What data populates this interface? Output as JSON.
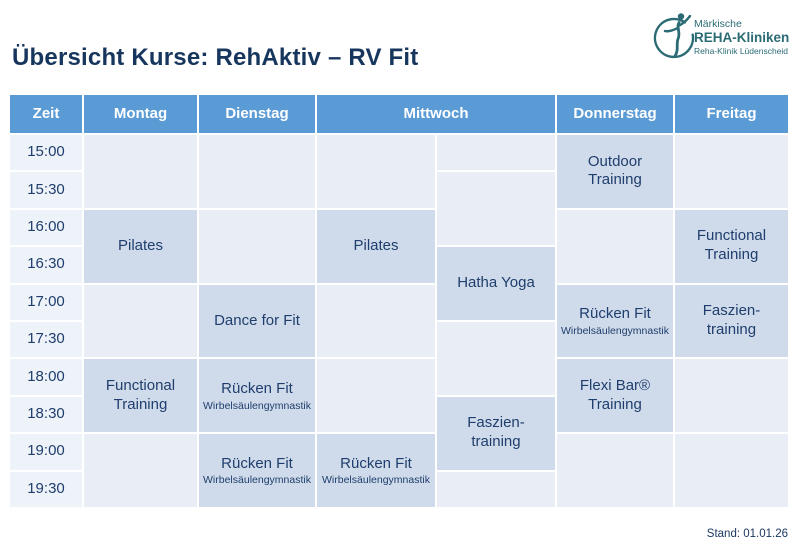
{
  "page": {
    "title": "Übersicht Kurse: RehAktiv – RV Fit",
    "stand": "Stand: 01.01.26"
  },
  "logo": {
    "icon": "person-in-circle-icon",
    "line1": "Märkische",
    "line2": "REHA-Kliniken",
    "line3": "Reha-Klinik Lüdenscheid"
  },
  "colors": {
    "header_bg": "#5b9bd5",
    "header_text": "#ffffff",
    "time_cell_bg": "#eef2f9",
    "empty_cell_bg": "#e9eef6",
    "course_cell_bg": "#cfdbea",
    "text_dark": "#1f3e6d",
    "title_text": "#17365d",
    "logo_teal": "#2b6b74"
  },
  "schedule": {
    "header_cells": [
      {
        "id": "zeit",
        "label": "Zeit",
        "col": 1,
        "span": 1
      },
      {
        "id": "montag",
        "label": "Montag",
        "col": 2,
        "span": 1
      },
      {
        "id": "dienstag",
        "label": "Dienstag",
        "col": 3,
        "span": 1
      },
      {
        "id": "mittwoch",
        "label": "Mittwoch",
        "col": 4,
        "span": 2
      },
      {
        "id": "donnerstag",
        "label": "Donnerstag",
        "col": 6,
        "span": 1
      },
      {
        "id": "freitag",
        "label": "Freitag",
        "col": 7,
        "span": 1
      }
    ],
    "times": [
      "15:00",
      "15:30",
      "16:00",
      "16:30",
      "17:00",
      "17:30",
      "18:00",
      "18:30",
      "19:00",
      "19:30"
    ],
    "cells": [
      {
        "day": "montag",
        "col": 2,
        "start": "15:00",
        "slots": 2,
        "title": "",
        "subtitle": "",
        "filled": false
      },
      {
        "day": "montag",
        "col": 2,
        "start": "16:00",
        "slots": 2,
        "title": "Pilates",
        "subtitle": "",
        "filled": true
      },
      {
        "day": "montag",
        "col": 2,
        "start": "17:00",
        "slots": 2,
        "title": "",
        "subtitle": "",
        "filled": false
      },
      {
        "day": "montag",
        "col": 2,
        "start": "18:00",
        "slots": 2,
        "title": "Functional\nTraining",
        "subtitle": "",
        "filled": true
      },
      {
        "day": "montag",
        "col": 2,
        "start": "19:00",
        "slots": 2,
        "title": "",
        "subtitle": "",
        "filled": false
      },
      {
        "day": "dienstag",
        "col": 3,
        "start": "15:00",
        "slots": 2,
        "title": "",
        "subtitle": "",
        "filled": false
      },
      {
        "day": "dienstag",
        "col": 3,
        "start": "16:00",
        "slots": 2,
        "title": "",
        "subtitle": "",
        "filled": false
      },
      {
        "day": "dienstag",
        "col": 3,
        "start": "17:00",
        "slots": 2,
        "title": "Dance for Fit",
        "subtitle": "",
        "filled": true
      },
      {
        "day": "dienstag",
        "col": 3,
        "start": "18:00",
        "slots": 2,
        "title": "Rücken Fit",
        "subtitle": "Wirbelsäulengymnastik",
        "filled": true
      },
      {
        "day": "dienstag",
        "col": 3,
        "start": "19:00",
        "slots": 2,
        "title": "Rücken Fit",
        "subtitle": "Wirbelsäulengymnastik",
        "filled": true
      },
      {
        "day": "mittwoch-1",
        "col": 4,
        "start": "15:00",
        "slots": 2,
        "title": "",
        "subtitle": "",
        "filled": false
      },
      {
        "day": "mittwoch-1",
        "col": 4,
        "start": "16:00",
        "slots": 2,
        "title": "Pilates",
        "subtitle": "",
        "filled": true
      },
      {
        "day": "mittwoch-1",
        "col": 4,
        "start": "17:00",
        "slots": 2,
        "title": "",
        "subtitle": "",
        "filled": false
      },
      {
        "day": "mittwoch-1",
        "col": 4,
        "start": "18:00",
        "slots": 2,
        "title": "",
        "subtitle": "",
        "filled": false
      },
      {
        "day": "mittwoch-1",
        "col": 4,
        "start": "19:00",
        "slots": 2,
        "title": "Rücken Fit",
        "subtitle": "Wirbelsäulengymnastik",
        "filled": true
      },
      {
        "day": "mittwoch-2",
        "col": 5,
        "start": "15:00",
        "slots": 1,
        "title": "",
        "subtitle": "",
        "filled": false
      },
      {
        "day": "mittwoch-2",
        "col": 5,
        "start": "15:30",
        "slots": 2,
        "title": "",
        "subtitle": "",
        "filled": false
      },
      {
        "day": "mittwoch-2",
        "col": 5,
        "start": "16:30",
        "slots": 2,
        "title": "Hatha Yoga",
        "subtitle": "",
        "filled": true
      },
      {
        "day": "mittwoch-2",
        "col": 5,
        "start": "17:30",
        "slots": 2,
        "title": "",
        "subtitle": "",
        "filled": false
      },
      {
        "day": "mittwoch-2",
        "col": 5,
        "start": "18:30",
        "slots": 2,
        "title": "Faszien-\ntraining",
        "subtitle": "",
        "filled": true
      },
      {
        "day": "mittwoch-2",
        "col": 5,
        "start": "19:30",
        "slots": 1,
        "title": "",
        "subtitle": "",
        "filled": false
      },
      {
        "day": "donnerstag",
        "col": 6,
        "start": "15:00",
        "slots": 2,
        "title": "Outdoor\nTraining",
        "subtitle": "",
        "filled": true
      },
      {
        "day": "donnerstag",
        "col": 6,
        "start": "16:00",
        "slots": 2,
        "title": "",
        "subtitle": "",
        "filled": false
      },
      {
        "day": "donnerstag",
        "col": 6,
        "start": "17:00",
        "slots": 2,
        "title": "Rücken Fit",
        "subtitle": "Wirbelsäulengymnastik",
        "filled": true
      },
      {
        "day": "donnerstag",
        "col": 6,
        "start": "18:00",
        "slots": 2,
        "title": "Flexi Bar®\nTraining",
        "subtitle": "",
        "filled": true
      },
      {
        "day": "donnerstag",
        "col": 6,
        "start": "19:00",
        "slots": 2,
        "title": "",
        "subtitle": "",
        "filled": false
      },
      {
        "day": "freitag",
        "col": 7,
        "start": "15:00",
        "slots": 2,
        "title": "",
        "subtitle": "",
        "filled": false
      },
      {
        "day": "freitag",
        "col": 7,
        "start": "16:00",
        "slots": 2,
        "title": "Functional\nTraining",
        "subtitle": "",
        "filled": true
      },
      {
        "day": "freitag",
        "col": 7,
        "start": "17:00",
        "slots": 2,
        "title": "Faszien-\ntraining",
        "subtitle": "",
        "filled": true
      },
      {
        "day": "freitag",
        "col": 7,
        "start": "18:00",
        "slots": 2,
        "title": "",
        "subtitle": "",
        "filled": false
      },
      {
        "day": "freitag",
        "col": 7,
        "start": "19:00",
        "slots": 2,
        "title": "",
        "subtitle": "",
        "filled": false
      }
    ]
  }
}
